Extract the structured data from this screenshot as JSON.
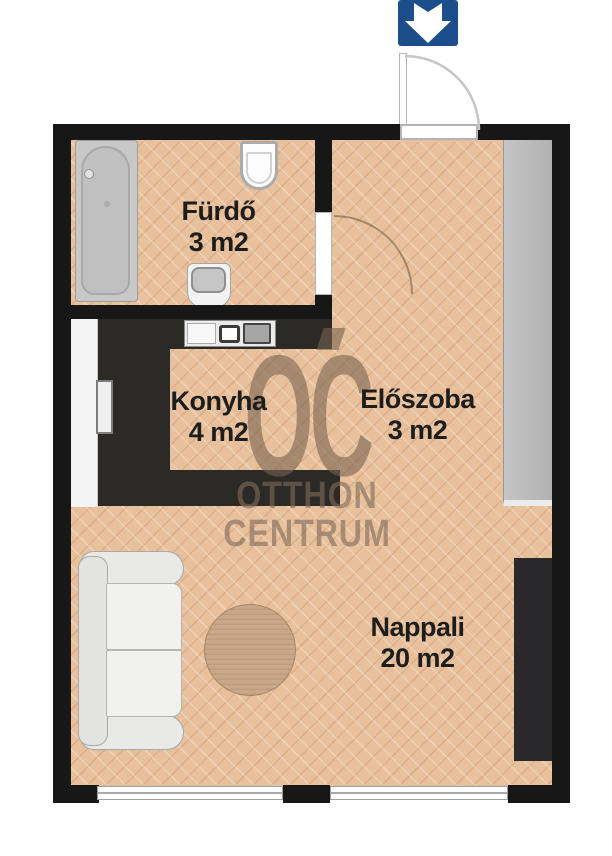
{
  "plan": {
    "watermark": {
      "logo_text": "OC",
      "brand_line1": "OTTHON",
      "brand_line2": "CENTRUM"
    },
    "rooms": [
      {
        "name": "Fürdő",
        "area": "3 m2"
      },
      {
        "name": "Konyha",
        "area": "4 m2"
      },
      {
        "name": "Előszoba",
        "area": "3 m2"
      },
      {
        "name": "Nappali",
        "area": "20 m2"
      }
    ],
    "fixtures": {
      "entrance_icon": "arrow-down",
      "items": [
        "bathtub",
        "toilet",
        "washbasin",
        "kitchen-counter",
        "kitchen-sink",
        "stove",
        "tall-cabinet",
        "appliance",
        "hall-closet",
        "sofa",
        "rug",
        "wardrobe",
        "entrance-door",
        "bathroom-door",
        "window",
        "window"
      ]
    },
    "colors": {
      "wall": "#171717",
      "floor": "#e8c09c",
      "entrance_arrow_bg": "#1c4e8c",
      "watermark": "#8c7460",
      "counter_dark": "#2b2a27",
      "closet_gray": "#bbbbbb",
      "wardrobe_dark": "#29292b",
      "label_text": "#1d1d1b"
    }
  }
}
